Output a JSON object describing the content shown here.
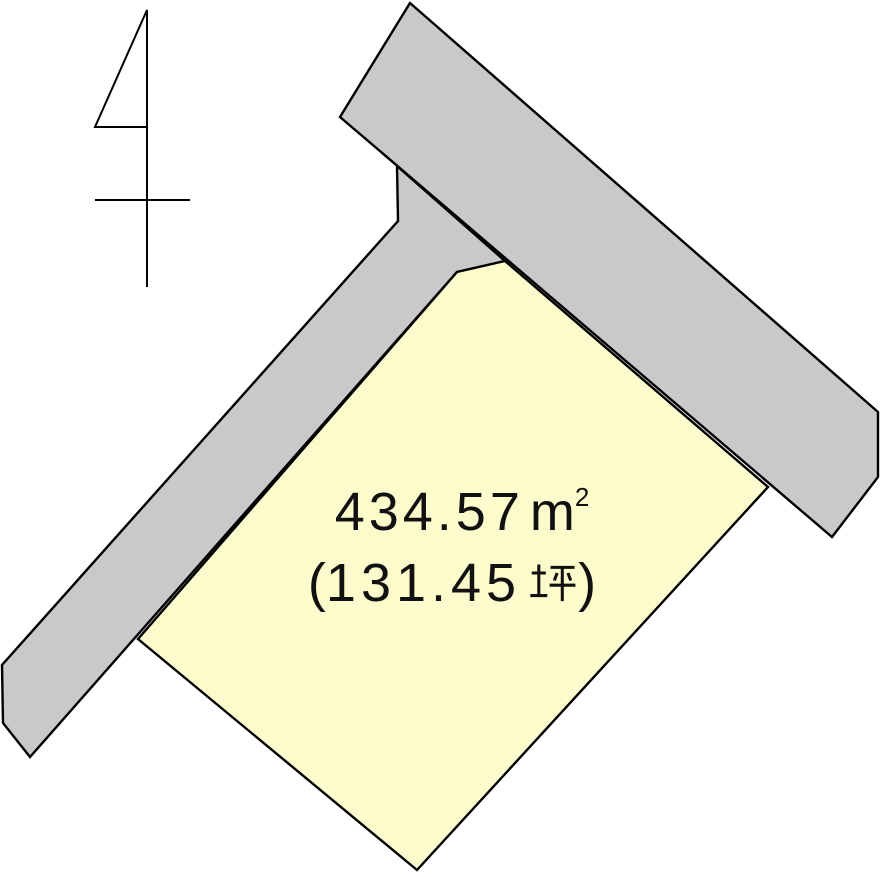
{
  "figure": {
    "kind": "land-plot-diagram",
    "background_color": "#ffffff",
    "road_fill_color": "#c9c9c9",
    "parcel_fill_color": "#fbfbcc",
    "outline_color": "#000000"
  },
  "parcel": {
    "area_m2_full": "４３４.５７㎡",
    "area_tsubo_full": "（１３１.４５坪）",
    "area_value": "434.57",
    "area_unit_base": "m",
    "area_unit_exponent": "2",
    "tsubo_open_paren": "(",
    "tsubo_value": "131.45",
    "tsubo_unit": "坪",
    "tsubo_close_paren": ")"
  }
}
